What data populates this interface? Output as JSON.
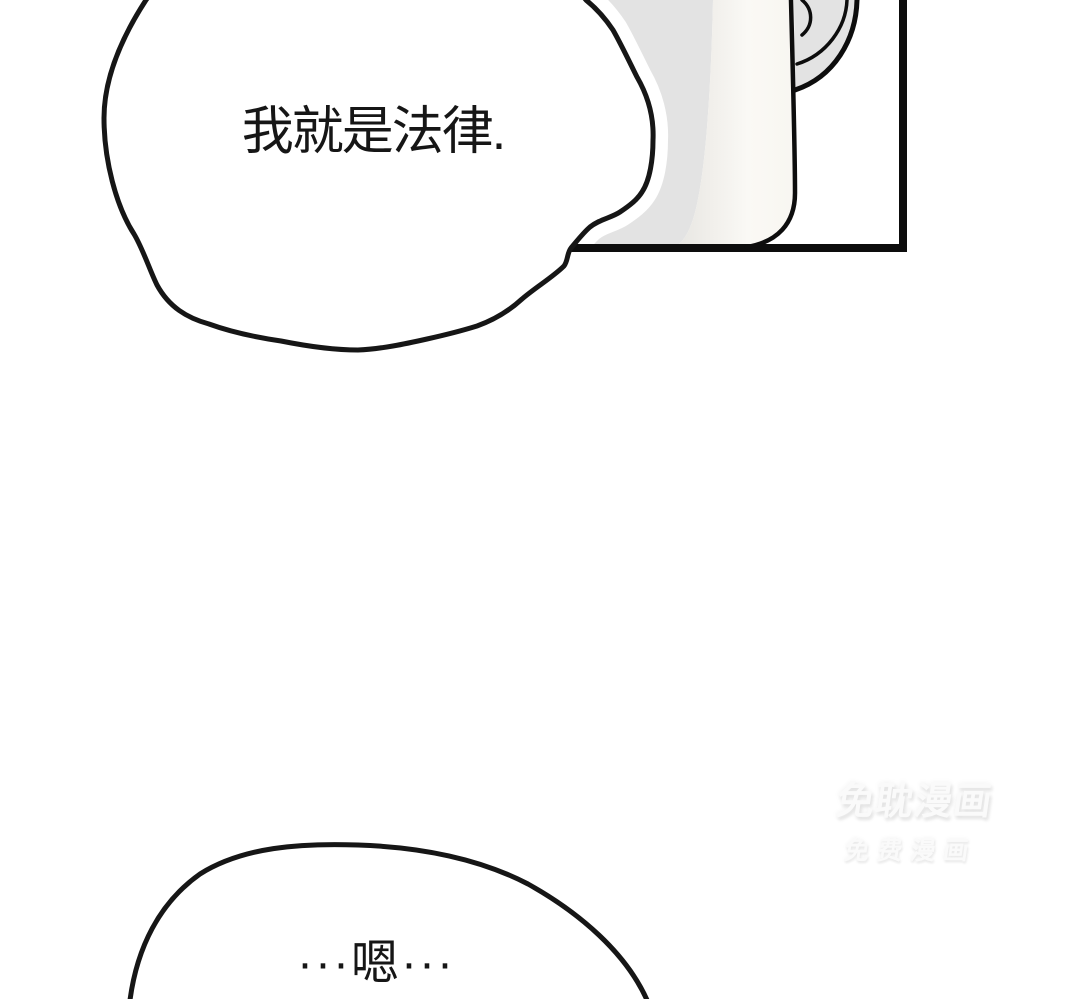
{
  "speech_bubbles": [
    {
      "text": "我就是法律."
    },
    {
      "text": "···嗯···"
    }
  ],
  "watermark": {
    "line1": "免耽漫画",
    "line2": "免费漫画"
  },
  "colors": {
    "ink": "#161616",
    "outline": "#0d0d0d",
    "panel_gray": "#e3e3e3",
    "mug_cream": "#faf9f5",
    "paper": "#ffffff",
    "watermark_fill": "#fafafa",
    "watermark_shadow": "#e2e2e2"
  }
}
